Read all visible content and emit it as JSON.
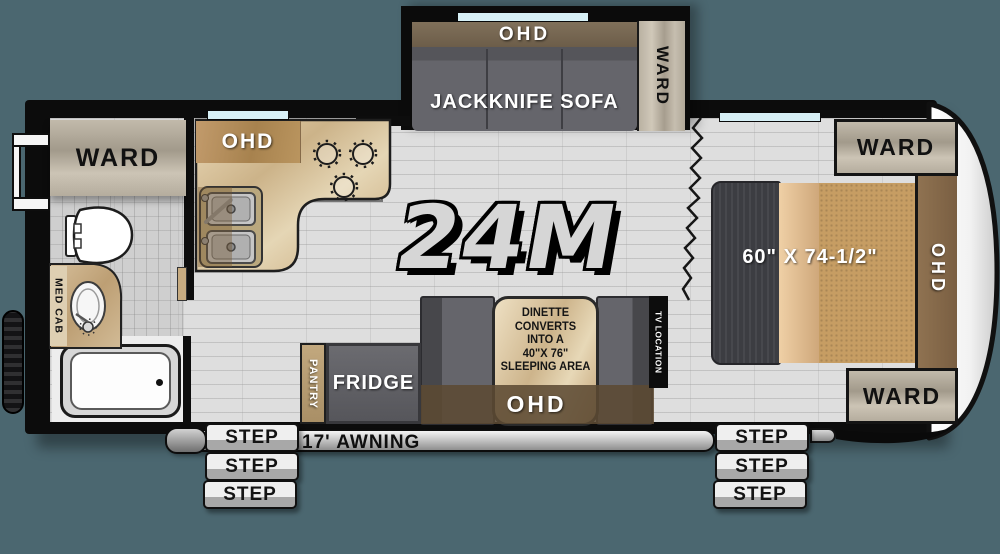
{
  "model": "24M",
  "colors": {
    "background": "#4b6770",
    "walls": "#0c0c0c",
    "window_glass": "#d7f0f6",
    "cabinet_brown": "#7a6450",
    "counter_tan": "#d9c49c",
    "furniture_gray": "#606065",
    "mattress_tan": "#c69d63",
    "wood_light": "#bdb4a6"
  },
  "slideout": {
    "ohd": "OHD",
    "sofa": "JACKKNIFE SOFA",
    "ward": "WARD"
  },
  "kitchen": {
    "ohd": "OHD"
  },
  "bathroom": {
    "ward": "WARD",
    "med_cab": "MED CAB"
  },
  "bedroom": {
    "bed_size": "60\" X 74-1/2\"",
    "ohd": "OHD",
    "ward_top": "WARD",
    "ward_bottom": "WARD"
  },
  "dinette": {
    "lines": [
      "DINETTE",
      "CONVERTS",
      "INTO A",
      "40\"X 76\"",
      "SLEEPING AREA"
    ],
    "ohd": "OHD",
    "tv": "TV LOCATION"
  },
  "galley": {
    "fridge": "FRIDGE",
    "pantry": "PANTRY"
  },
  "exterior": {
    "awning": "17' AWNING",
    "steps_left": [
      "STEP",
      "STEP",
      "STEP"
    ],
    "steps_right": [
      "STEP",
      "STEP",
      "STEP"
    ]
  }
}
